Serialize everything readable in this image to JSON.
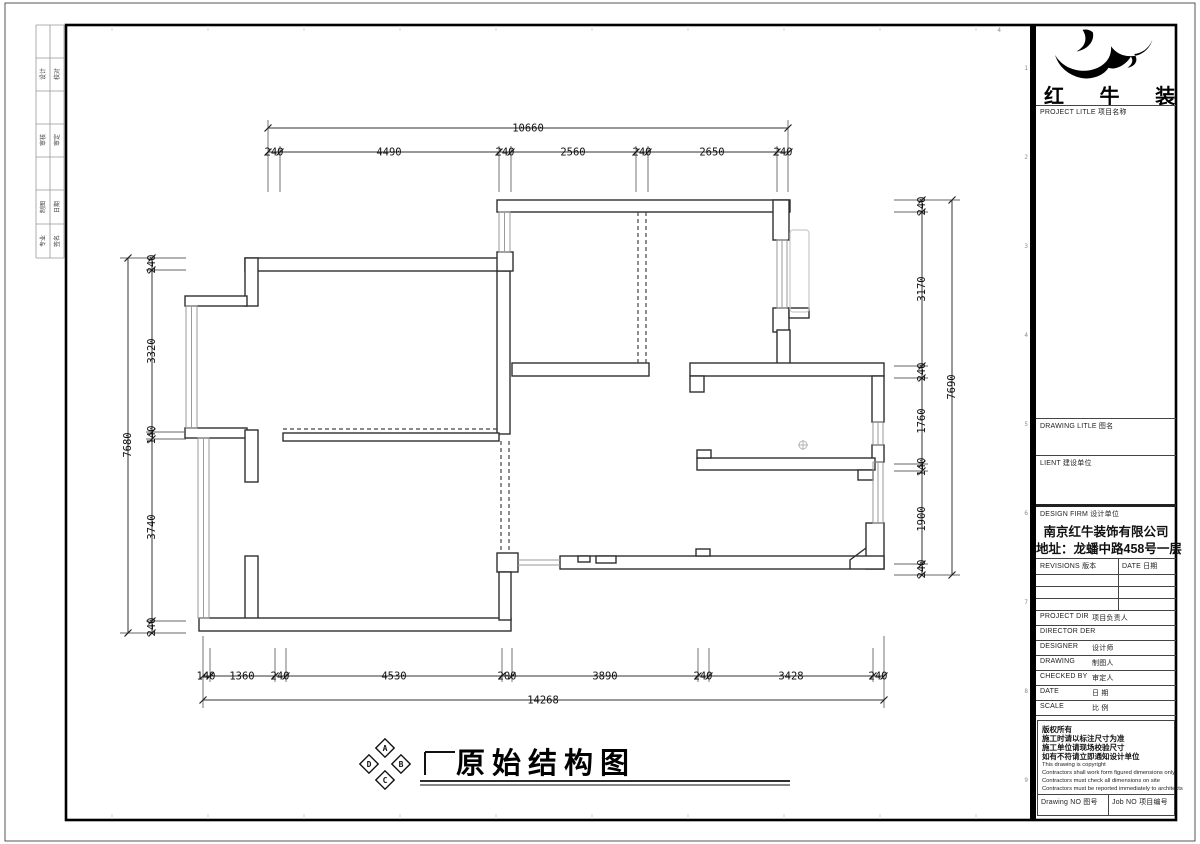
{
  "frame": {
    "side_table_rows": [
      [
        "设计",
        "校对"
      ],
      [
        "审核",
        "审定"
      ],
      [
        "制图",
        "日期"
      ],
      [
        "专业",
        "签名"
      ]
    ],
    "edge_numbers": [
      "1",
      "2",
      "3",
      "4",
      "5",
      "6",
      "7",
      "8",
      "9"
    ],
    "top_mark": "4"
  },
  "plan": {
    "dims": {
      "top": {
        "overall": "10660",
        "segments": [
          "240",
          "4490",
          "240",
          "2560",
          "240",
          "2650",
          "240"
        ]
      },
      "bottom": {
        "overall": "14268",
        "segments": [
          "140",
          "1360",
          "240",
          "4530",
          "200",
          "3890",
          "240",
          "3428",
          "240"
        ]
      },
      "left": {
        "overall": "7680",
        "segments": [
          "240",
          "3320",
          "140",
          "3740",
          "240"
        ]
      },
      "right": {
        "overall": "7690",
        "segments": [
          "240",
          "3170",
          "240",
          "1760",
          "140",
          "1900",
          "240"
        ]
      }
    }
  },
  "title_bar": {
    "title": "原始结构图",
    "compass": [
      "A",
      "B",
      "C",
      "D"
    ]
  },
  "title_block": {
    "logo_text": "红 牛 装 饰",
    "project_title_label": "PROJECT LITLE 项目名称",
    "drawing_title_label": "DRAWING LITLE 图名",
    "client_label": "LIENT 建设单位",
    "design_firm_label": "DESIGN FIRM 设计单位",
    "firm_name": "南京红牛装饰有限公司",
    "firm_address": "地址：龙蟠中路458号一层",
    "revisions_label": "REVISIONS 版本",
    "date_col_label": "DATE 日期",
    "fields": [
      {
        "en": "PROJECT DIR",
        "cn": "项目负责人"
      },
      {
        "en": "DIRECTOR DER",
        "cn": ""
      },
      {
        "en": "DESIGNER",
        "cn": "设计师"
      },
      {
        "en": "DRAWING",
        "cn": "制图人"
      },
      {
        "en": "CHECKED BY",
        "cn": "审定人"
      },
      {
        "en": "DATE",
        "cn": "日 期"
      },
      {
        "en": "SCALE",
        "cn": "比 例"
      }
    ],
    "notes_cn": [
      "版权所有",
      "施工时请以标注尺寸为准",
      "施工单位请现场校验尺寸",
      "如有不符请立即通知设计单位"
    ],
    "notes_en": [
      "This drawing is copyright",
      "Contractors shall work form figured dimensions only",
      "Contractors must check all dimensions on site",
      "Contractors must be reported immediately to architects"
    ],
    "drawing_no_label": "Drawing NO 图号",
    "job_no_label": "Job NO 项目编号"
  }
}
